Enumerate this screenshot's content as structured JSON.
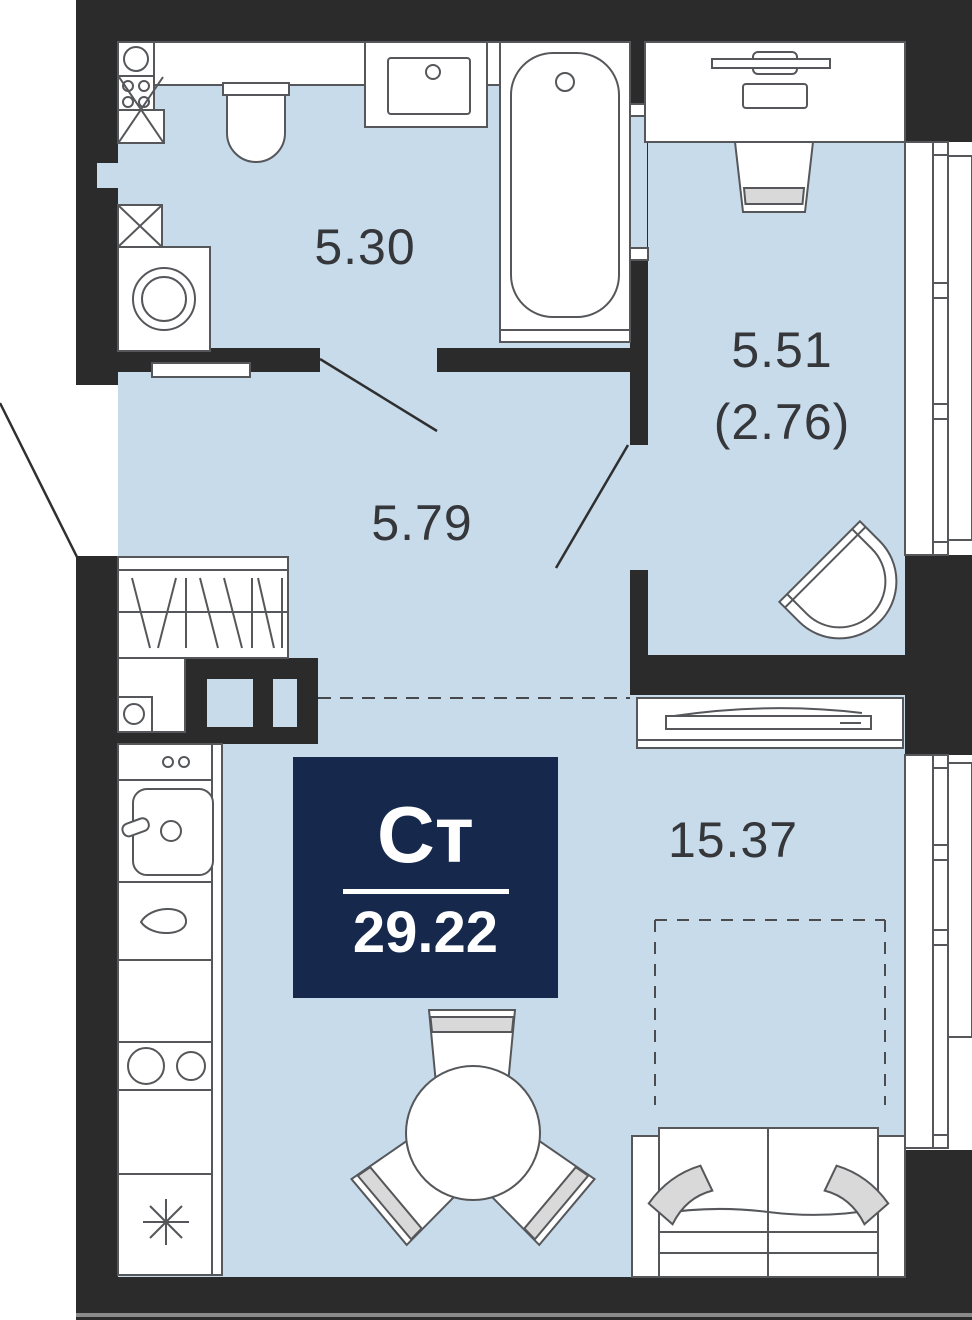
{
  "unit_badge": {
    "type_label": "Ст",
    "area_value": "29.22"
  },
  "room_labels": {
    "bathroom": "5.30",
    "hallway": "5.79",
    "loggia_primary": "5.51",
    "loggia_secondary": "(2.76)",
    "living": "15.37"
  },
  "colors": {
    "wall": "#2b2b2b",
    "floor": "#c8dbeb",
    "badge_bg": "#16294c",
    "furniture_outline": "#55575a",
    "soft_gray": "#d9d9d9",
    "label_text": "#35373a"
  },
  "fixtures": [
    "toilet",
    "vanity-sink",
    "bathtub",
    "washing-machine",
    "ventilation-shaft",
    "water-heater",
    "wardrobe",
    "kitchen-counter",
    "kitchen-sink",
    "cooktop",
    "fridge",
    "dining-table",
    "dining-chair",
    "sofa",
    "bed-outline",
    "dresser",
    "desk",
    "desk-chair",
    "armchair",
    "window",
    "entrance-door-swing",
    "bathroom-door-swing",
    "loggia-door-swing"
  ]
}
